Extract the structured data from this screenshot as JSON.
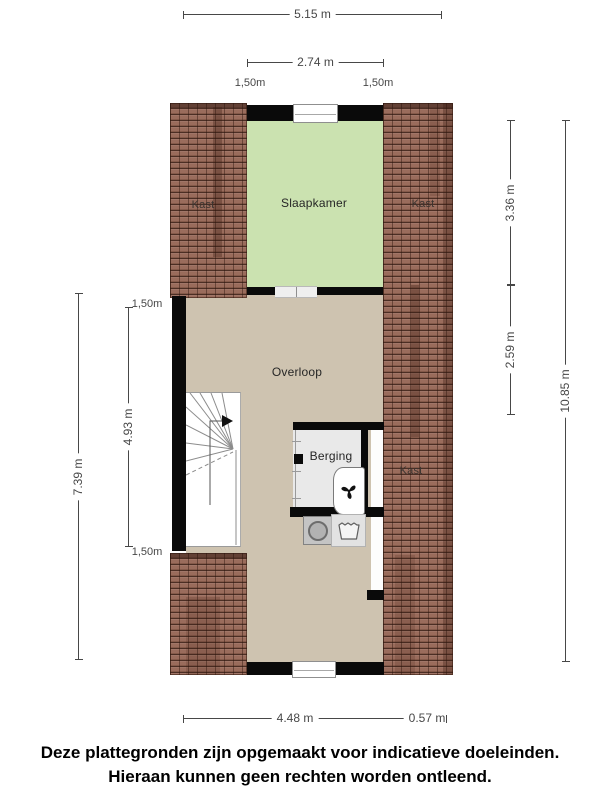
{
  "rooms": {
    "kast_top_left": "Kast",
    "slaapkamer": "Slaapkamer",
    "kast_top_right": "Kast",
    "overloop": "Overloop",
    "berging": "Berging",
    "kast_middle_right": "Kast"
  },
  "dimensions": {
    "top_total": "5.15 m",
    "top_inner": "2.74 m",
    "top_left_small": "1,50m",
    "top_right_small": "1,50m",
    "left_total": "7.39 m",
    "left_inner": "4.93 m",
    "left_small_top": "1,50m",
    "left_small_bottom": "1,50m",
    "right_upper": "3.36 m",
    "right_lower": "2.59 m",
    "right_total": "10.85 m",
    "bottom_main": "4.48 m",
    "bottom_right": "0.57 m"
  },
  "footer": {
    "line1": "Deze plattegronden zijn opgemaakt voor indicatieve doeleinden.",
    "line2": "Hieraan kunnen geen rechten worden ontleend."
  },
  "icons": {
    "fan": "fan-icon",
    "washing_machine": "washing-machine-icon",
    "sink": "sink-icon",
    "stairs_arrow": "stairs-arrow-icon"
  },
  "colors": {
    "roof": "#9a6c5c",
    "bedroom": "#cbe2b0",
    "landing": "#cec3b0",
    "storage": "#e9e9e9",
    "wall": "#0a0a0a",
    "dim": "#474747"
  }
}
